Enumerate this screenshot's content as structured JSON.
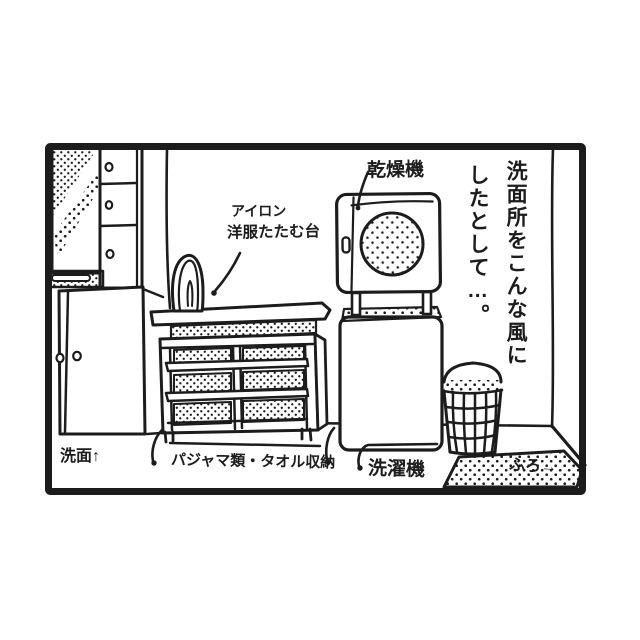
{
  "colors": {
    "ink": "#1c1c1c",
    "paper": "#ffffff"
  },
  "panel": {
    "caption": {
      "line1": "洗面所をこんな風に",
      "line2": "したとして…。"
    },
    "labels": {
      "dryer": "乾燥機",
      "iron_line1": "アイロン",
      "iron_line2": "洋服たたむ台",
      "washroom": "洗面↑",
      "storage": "パジャマ類・タオル収納",
      "washer": "洗濯機",
      "bath_mat": "ふろ→"
    }
  }
}
